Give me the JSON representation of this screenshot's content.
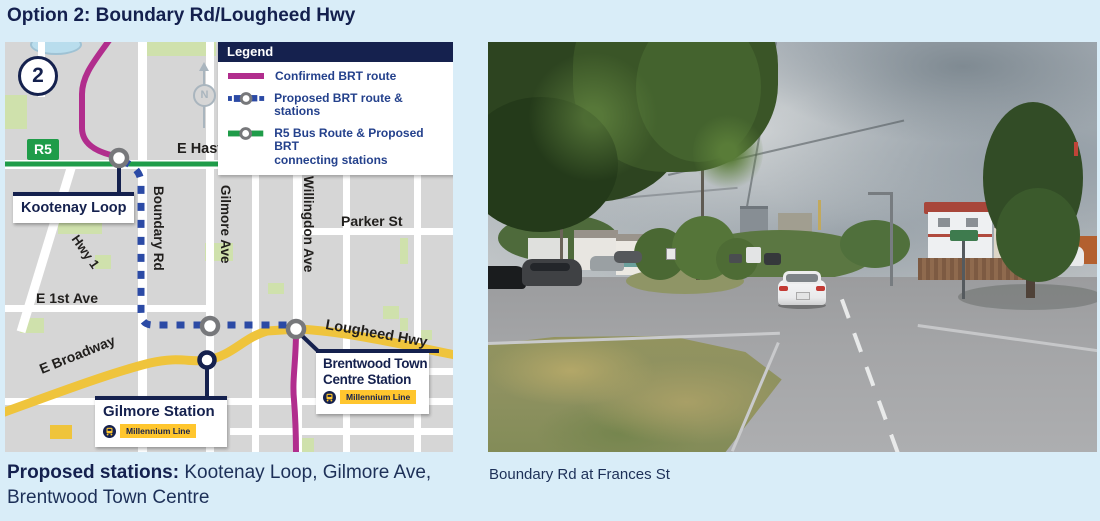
{
  "page": {
    "title": "Option 2: Boundary Rd/Lougheed Hwy"
  },
  "map": {
    "option_number": "2",
    "r5_badge": "R5",
    "compass": "N",
    "legend": {
      "title": "Legend",
      "items": [
        {
          "label": "Confirmed BRT route"
        },
        {
          "label": "Proposed BRT route & stations"
        },
        {
          "label_line1": "R5 Bus Route & Proposed BRT",
          "label_line2": "connecting stations"
        }
      ]
    },
    "streets": {
      "e_hastings": "E Hastings St",
      "boundary": "Boundary Rd",
      "gilmore": "Gilmore Ave",
      "willingdon": "Willingdon Ave",
      "parker": "Parker St",
      "hwy1": "Hwy 1",
      "e_1st": "E 1st Ave",
      "e_broadway": "E Broadway",
      "lougheed": "Lougheed Hwy"
    },
    "stations": {
      "kootenay": {
        "label": "Kootenay Loop"
      },
      "gilmore": {
        "label": "Gilmore Station",
        "line": "Millennium Line"
      },
      "brentwood": {
        "label_line1": "Brentwood Town",
        "label_line2": "Centre Station",
        "line": "Millennium Line"
      }
    },
    "colors": {
      "confirmed_route": "#b12d8d",
      "proposed_route": "#2b4aa5",
      "r5_route": "#1f9c49",
      "navy": "#15214e",
      "highway_yellow": "#efc43c",
      "millennium_badge": "#ffc62e"
    }
  },
  "photo": {
    "caption": "Boundary Rd at Frances St"
  },
  "footer": {
    "lead": "Proposed stations:",
    "stations_list": " Kootenay Loop, Gilmore Ave, Brentwood Town Centre"
  }
}
